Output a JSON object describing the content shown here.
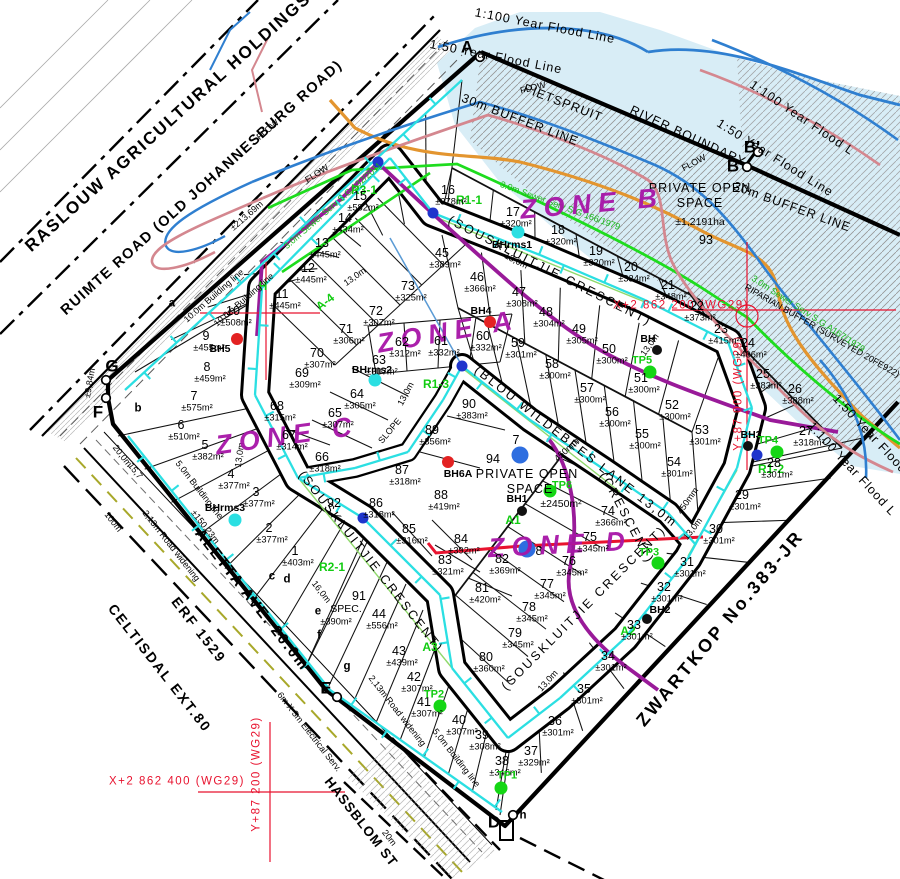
{
  "site": {
    "holdings": "RASLOUW AGRICULTURAL HOLDINGS",
    "ruimte": "RUIMTE ROAD (OLD JOHANNESBURG ROAD)",
    "zwartkop": "ZWARTKOP No.383-JR",
    "aletta": "ALETTA AVE. 20.0m",
    "erf1529": "ERF 1529",
    "celtisdal": "CELTISDAL EXT.80",
    "hassblom": "HASSBLOM ST"
  },
  "colors": {
    "flood_fill": "#d8edf6",
    "river": "#2f7fd0",
    "flood_50": "#d4878f",
    "buffer_30m": "#e3952f",
    "sewer": "#1edc1e",
    "water": "#2bdfe2",
    "zone_boundary": "#991a99",
    "grid_red": "#e8132f",
    "zone_text": "#a715a7"
  },
  "zones": [
    {
      "t": "ZONE A",
      "x": 448,
      "y": 332,
      "r": -10,
      "c": "zn"
    },
    {
      "t": "ZONE B",
      "x": 592,
      "y": 204,
      "r": -5,
      "c": "zn"
    },
    {
      "t": "ZONE C",
      "x": 287,
      "y": 436,
      "r": -8,
      "c": "zn"
    },
    {
      "t": "ZONE D",
      "x": 560,
      "y": 545,
      "r": -3,
      "c": "zn"
    }
  ],
  "labels": [
    {
      "t": "1:100 Year Flood Line",
      "x": 545,
      "y": 26,
      "r": 11,
      "c": "fl"
    },
    {
      "t": "1:50 Year Flood Line",
      "x": 496,
      "y": 57,
      "r": 11,
      "c": "fl"
    },
    {
      "t": "1:100 Year Flood L",
      "x": 802,
      "y": 118,
      "r": 34,
      "c": "fl"
    },
    {
      "t": "1:50 Year Flood Line",
      "x": 775,
      "y": 158,
      "r": 32,
      "c": "fl"
    },
    {
      "t": "1:50 Year Flood",
      "x": 870,
      "y": 434,
      "r": 47,
      "c": "fl"
    },
    {
      "t": "1:100 Year Flood L",
      "x": 852,
      "y": 469,
      "r": 47,
      "c": "fl"
    },
    {
      "t": "PIETSPRUIT",
      "x": 563,
      "y": 103,
      "r": 21,
      "c": "fl"
    },
    {
      "t": "RIVER BOUNDARY",
      "x": 688,
      "y": 136,
      "r": 25,
      "c": "fl"
    },
    {
      "t": "30m BUFFER LINE",
      "x": 520,
      "y": 120,
      "r": 21,
      "c": "fl"
    },
    {
      "t": "30m BUFFER LINE",
      "x": 792,
      "y": 207,
      "r": 20,
      "c": "fl"
    },
    {
      "t": "FLOW",
      "x": 268,
      "y": 130,
      "r": -40,
      "c": "dm"
    },
    {
      "t": "FLOW",
      "x": 317,
      "y": 174,
      "r": -33,
      "c": "dm"
    },
    {
      "t": "FLOW",
      "x": 533,
      "y": 88,
      "r": -14,
      "c": "dm"
    },
    {
      "t": "FLOW",
      "x": 694,
      "y": 163,
      "r": -28,
      "c": "dm"
    },
    {
      "t": "RIPARIAN BUFFER (SURVEYED 20FE922)",
      "x": 822,
      "y": 331,
      "r": 30,
      "c": "dm"
    },
    {
      "t": "(SOUSKLUITJIE CRESCENT)",
      "x": 550,
      "y": 271,
      "r": 27,
      "c": "rd"
    },
    {
      "t": "(SOUSKLUITJIE CRESCENT)",
      "x": 371,
      "y": 562,
      "r": 52,
      "c": "rd"
    },
    {
      "t": "(SOUSKLUITJIE CRESCENT)",
      "x": 584,
      "y": 608,
      "r": -45,
      "c": "rd"
    },
    {
      "t": "(CRESCENT)",
      "x": 627,
      "y": 518,
      "r": 62,
      "c": "rd"
    },
    {
      "t": "(BLOU WILDEBEES LANE 13,0m",
      "x": 576,
      "y": 447,
      "r": 38,
      "c": "rd"
    },
    {
      "t": "PRIVATE OPEN",
      "x": 700,
      "y": 188,
      "r": 0,
      "c": "os"
    },
    {
      "t": "SPACE",
      "x": 700,
      "y": 203,
      "r": 0,
      "c": "os"
    },
    {
      "t": "±1,2191ha",
      "x": 700,
      "y": 222,
      "r": 0,
      "c": "osa"
    },
    {
      "t": "93",
      "x": 706,
      "y": 240,
      "r": 0,
      "c": "num"
    },
    {
      "t": "94",
      "x": 493,
      "y": 459,
      "r": 0,
      "c": "num"
    },
    {
      "t": "PRIVATE OPEN",
      "x": 527,
      "y": 474,
      "r": 0,
      "c": "os"
    },
    {
      "t": "SPACE",
      "x": 530,
      "y": 489,
      "r": 0,
      "c": "os"
    },
    {
      "t": "±2450m²",
      "x": 561,
      "y": 504,
      "r": 0,
      "c": "osa"
    },
    {
      "t": "91",
      "x": 359,
      "y": 596,
      "r": 0,
      "c": "num"
    },
    {
      "t": "SPEC.",
      "x": 346,
      "y": 609,
      "r": 0,
      "c": "osa"
    },
    {
      "t": "±390m²",
      "x": 336,
      "y": 622,
      "r": 0,
      "c": "ar"
    },
    {
      "t": "92",
      "x": 334,
      "y": 503,
      "r": 0,
      "c": "num"
    },
    {
      "t": "7",
      "x": 516,
      "y": 440,
      "r": 0,
      "c": "num"
    },
    {
      "t": "8",
      "x": 539,
      "y": 551,
      "r": 0,
      "c": "num"
    },
    {
      "t": "3.0m Sewer Serv S.G.132/2011",
      "x": 333,
      "y": 206,
      "r": -41,
      "c": "gr"
    },
    {
      "t": "3.0m Sewer Serv S.G 166/1979",
      "x": 560,
      "y": 206,
      "r": 20,
      "c": "gr"
    },
    {
      "t": "3.0m Sewer Serv S.G.A167/1979",
      "x": 808,
      "y": 314,
      "r": 33,
      "c": "gr"
    },
    {
      "t": "R3-1",
      "x": 364,
      "y": 190,
      "r": 0,
      "c": "grb"
    },
    {
      "t": "R1-1",
      "x": 469,
      "y": 200,
      "r": 0,
      "c": "grb"
    },
    {
      "t": "A-4",
      "x": 325,
      "y": 302,
      "r": -38,
      "c": "grb"
    },
    {
      "t": "H",
      "x": 263,
      "y": 286,
      "r": 0,
      "c": "grb"
    },
    {
      "t": "R1-3",
      "x": 436,
      "y": 384,
      "r": 0,
      "c": "grb"
    },
    {
      "t": "A1",
      "x": 513,
      "y": 520,
      "r": 0,
      "c": "grb"
    },
    {
      "t": "A3",
      "x": 430,
      "y": 647,
      "r": 0,
      "c": "grb"
    },
    {
      "t": "A2",
      "x": 628,
      "y": 631,
      "r": 0,
      "c": "grb"
    },
    {
      "t": "R2-1",
      "x": 332,
      "y": 567,
      "r": 0,
      "c": "grb"
    },
    {
      "t": "R1-2",
      "x": 771,
      "y": 469,
      "r": 0,
      "c": "grb"
    },
    {
      "t": "X+2 862 200 (WG29)",
      "x": 681,
      "y": 306,
      "r": 0,
      "c": "rr"
    },
    {
      "t": "Y+87 000 (WG29)",
      "x": 739,
      "y": 393,
      "r": -90,
      "c": "rr"
    },
    {
      "t": "X+2 862 400 (WG29)",
      "x": 177,
      "y": 782,
      "r": 0,
      "c": "rr"
    },
    {
      "t": "Y+87 200 (WG29)",
      "x": 257,
      "y": 774,
      "r": -90,
      "c": "rr"
    },
    {
      "t": "±213,69m",
      "x": 247,
      "y": 216,
      "r": -41,
      "c": "dm"
    },
    {
      "t": "±150,23m",
      "x": 205,
      "y": 527,
      "r": 52,
      "c": "dm"
    },
    {
      "t": "100m",
      "x": 113,
      "y": 522,
      "r": 52,
      "c": "dm"
    },
    {
      "t": "20,0m",
      "x": 122,
      "y": 456,
      "r": 52,
      "c": "dm"
    },
    {
      "t": "15,7",
      "x": 135,
      "y": 471,
      "r": 52,
      "c": "dm"
    },
    {
      "t": "16,0m",
      "x": 321,
      "y": 592,
      "r": 52,
      "c": "dm"
    },
    {
      "t": "20m",
      "x": 389,
      "y": 838,
      "r": 52,
      "c": "dm"
    },
    {
      "t": "±9,84m",
      "x": 90,
      "y": 383,
      "r": -80,
      "c": "dm"
    },
    {
      "t": "13,0m",
      "x": 516,
      "y": 261,
      "r": 27,
      "c": "dm"
    },
    {
      "t": "13,0m",
      "x": 355,
      "y": 277,
      "r": -35,
      "c": "dm"
    },
    {
      "t": "13,0m",
      "x": 406,
      "y": 394,
      "r": -62,
      "c": "dm"
    },
    {
      "t": "13,0m",
      "x": 240,
      "y": 455,
      "r": -82,
      "c": "dm"
    },
    {
      "t": "13,0m",
      "x": 650,
      "y": 345,
      "r": -55,
      "c": "dm"
    },
    {
      "t": "13,0m",
      "x": 693,
      "y": 529,
      "r": -52,
      "c": "dm"
    },
    {
      "t": "13,0m",
      "x": 548,
      "y": 681,
      "r": -48,
      "c": "dm"
    },
    {
      "t": "10.0m Building line",
      "x": 214,
      "y": 296,
      "r": -41,
      "c": "dm"
    },
    {
      "t": "10.0m Building line",
      "x": 244,
      "y": 300,
      "r": -41,
      "c": "dm"
    },
    {
      "t": "5.0m Building line",
      "x": 199,
      "y": 490,
      "r": 52,
      "c": "dm"
    },
    {
      "t": "5,0m Building line",
      "x": 456,
      "y": 758,
      "r": 52,
      "c": "dm"
    },
    {
      "t": "2,13m Road widening",
      "x": 171,
      "y": 546,
      "r": 52,
      "c": "dm"
    },
    {
      "t": "2,13m Road widening",
      "x": 397,
      "y": 711,
      "r": 52,
      "c": "dm"
    },
    {
      "t": "6m X 3m Electrical Serv.",
      "x": 309,
      "y": 732,
      "r": 52,
      "c": "dm"
    },
    {
      "t": "SLOPE",
      "x": 390,
      "y": 431,
      "r": -50,
      "c": "dm"
    },
    {
      "t": "450mm",
      "x": 567,
      "y": 450,
      "r": -42,
      "c": "dm"
    },
    {
      "t": "450mm",
      "x": 688,
      "y": 501,
      "r": -55,
      "c": "dm"
    },
    {
      "t": "A",
      "x": 467,
      "y": 47,
      "r": 0,
      "c": "lt"
    },
    {
      "t": "B",
      "x": 733,
      "y": 166,
      "r": 0,
      "c": "lt"
    },
    {
      "t": "B'",
      "x": 752,
      "y": 147,
      "r": 0,
      "c": "lt"
    },
    {
      "t": "D",
      "x": 494,
      "y": 822,
      "r": 0,
      "c": "lt"
    },
    {
      "t": "E",
      "x": 326,
      "y": 688,
      "r": 0,
      "c": "lt"
    },
    {
      "t": "F",
      "x": 98,
      "y": 412,
      "r": 0,
      "c": "lt"
    },
    {
      "t": "G",
      "x": 112,
      "y": 366,
      "r": 0,
      "c": "lt"
    },
    {
      "t": "a",
      "x": 172,
      "y": 304,
      "r": 0,
      "c": "ls"
    },
    {
      "t": "b",
      "x": 138,
      "y": 409,
      "r": 0,
      "c": "ls"
    },
    {
      "t": "c",
      "x": 272,
      "y": 577,
      "r": 0,
      "c": "ls"
    },
    {
      "t": "d",
      "x": 287,
      "y": 580,
      "r": 0,
      "c": "ls"
    },
    {
      "t": "e",
      "x": 318,
      "y": 612,
      "r": 0,
      "c": "ls"
    },
    {
      "t": "f",
      "x": 319,
      "y": 636,
      "r": 0,
      "c": "ls"
    },
    {
      "t": "g",
      "x": 347,
      "y": 667,
      "r": 0,
      "c": "ls"
    },
    {
      "t": "h",
      "x": 523,
      "y": 816,
      "r": 0,
      "c": "ls"
    }
  ],
  "plots": [
    [
      1,
      "±403m²",
      295,
      551
    ],
    [
      2,
      "±377m²",
      269,
      528
    ],
    [
      3,
      "±377m²",
      256,
      492
    ],
    [
      4,
      "±377m²",
      231,
      474
    ],
    [
      5,
      "±382m²",
      205,
      445
    ],
    [
      6,
      "±510m²",
      181,
      425
    ],
    [
      7,
      "±575m²",
      194,
      396
    ],
    [
      8,
      "±459m²",
      207,
      367
    ],
    [
      9,
      "±455m²",
      206,
      336
    ],
    [
      10,
      "±508m²",
      233,
      311
    ],
    [
      11,
      "±445m²",
      282,
      294
    ],
    [
      12,
      "±445m²",
      308,
      268
    ],
    [
      13,
      "±445m²",
      322,
      243
    ],
    [
      14,
      "±434m²",
      345,
      218
    ],
    [
      15,
      "±582m²",
      360,
      196
    ],
    [
      16,
      "±378m²",
      448,
      190
    ],
    [
      17,
      "±320m²",
      513,
      212
    ],
    [
      18,
      "±320m²",
      558,
      230
    ],
    [
      19,
      "±320m²",
      596,
      251
    ],
    [
      20,
      "±334m²",
      631,
      267
    ],
    [
      21,
      "±348m²",
      668,
      285
    ],
    [
      22,
      "±373m²",
      697,
      306
    ],
    [
      23,
      "±415m²",
      721,
      329
    ],
    [
      24,
      "±406m²",
      748,
      343
    ],
    [
      25,
      "±383m²",
      763,
      374
    ],
    [
      26,
      "±388m²",
      795,
      389
    ],
    [
      27,
      "±318m²",
      806,
      431
    ],
    [
      28,
      "±301m²",
      774,
      463
    ],
    [
      29,
      "±301m²",
      742,
      495
    ],
    [
      30,
      "±301m²",
      716,
      529
    ],
    [
      31,
      "±301m²",
      687,
      562
    ],
    [
      32,
      "±301m²",
      664,
      587
    ],
    [
      33,
      "±301m²",
      634,
      625
    ],
    [
      34,
      "±301m²",
      608,
      656
    ],
    [
      35,
      "±301m²",
      584,
      689
    ],
    [
      36,
      "±301m²",
      555,
      721
    ],
    [
      37,
      "±329m²",
      531,
      751
    ],
    [
      38,
      "±346m²",
      502,
      761
    ],
    [
      39,
      "±308m²",
      482,
      735
    ],
    [
      40,
      "±307m²",
      459,
      720
    ],
    [
      41,
      "±307m²",
      424,
      702
    ],
    [
      42,
      "±307m²",
      414,
      677
    ],
    [
      43,
      "±439m²",
      399,
      651
    ],
    [
      44,
      "±556m²",
      379,
      614
    ],
    [
      45,
      "±389m²",
      442,
      253
    ],
    [
      46,
      "±366m²",
      477,
      277
    ],
    [
      47,
      "±308m²",
      519,
      292
    ],
    [
      48,
      "±304m²",
      546,
      312
    ],
    [
      49,
      "±305m²",
      579,
      329
    ],
    [
      50,
      "±300m²",
      609,
      349
    ],
    [
      51,
      "±300m²",
      641,
      378
    ],
    [
      52,
      "±300m²",
      672,
      405
    ],
    [
      53,
      "±301m²",
      702,
      430
    ],
    [
      54,
      "±301m²",
      674,
      462
    ],
    [
      55,
      "±300m²",
      642,
      434
    ],
    [
      56,
      "±300m²",
      612,
      412
    ],
    [
      57,
      "±300m²",
      587,
      388
    ],
    [
      58,
      "±300m²",
      552,
      364
    ],
    [
      59,
      "±301m²",
      518,
      343
    ],
    [
      60,
      "±332m²",
      483,
      336
    ],
    [
      61,
      "±332m²",
      441,
      341
    ],
    [
      62,
      "±312m²",
      402,
      342
    ],
    [
      63,
      "±307m²",
      379,
      360
    ],
    [
      64,
      "±305m²",
      357,
      394
    ],
    [
      65,
      "±307m²",
      335,
      413
    ],
    [
      66,
      "±318m²",
      322,
      457
    ],
    [
      67,
      "±314m²",
      289,
      435
    ],
    [
      68,
      "±315m²",
      277,
      406
    ],
    [
      69,
      "±309m²",
      302,
      373
    ],
    [
      70,
      "±307m²",
      317,
      353
    ],
    [
      71,
      "±306m²",
      346,
      329
    ],
    [
      72,
      "±307m²",
      376,
      311
    ],
    [
      73,
      "±325m²",
      408,
      286
    ],
    [
      74,
      "±366m²",
      608,
      511
    ],
    [
      75,
      "±345m²",
      590,
      537
    ],
    [
      76,
      "±345m²",
      569,
      561
    ],
    [
      77,
      "±345m²",
      547,
      584
    ],
    [
      78,
      "±345m²",
      529,
      607
    ],
    [
      79,
      "±345m²",
      515,
      633
    ],
    [
      80,
      "±360m²",
      486,
      657
    ],
    [
      81,
      "±420m²",
      482,
      588
    ],
    [
      82,
      "±369m²",
      502,
      559
    ],
    [
      83,
      "±321m²",
      445,
      560
    ],
    [
      84,
      "±392m²",
      461,
      539
    ],
    [
      85,
      "±316m²",
      409,
      529
    ],
    [
      86,
      "±318m²",
      376,
      503
    ],
    [
      87,
      "±318m²",
      402,
      470
    ],
    [
      88,
      "±419m²",
      441,
      495
    ],
    [
      89,
      "±356m²",
      432,
      430
    ],
    [
      90,
      "±383m²",
      469,
      404
    ]
  ],
  "markers": {
    "boreholes": [
      {
        "id": "BH5",
        "type": "red",
        "x": 237,
        "y": 339,
        "lx": 220,
        "ly": 349
      },
      {
        "id": "BH4",
        "type": "red",
        "x": 490,
        "y": 322,
        "lx": 481,
        "ly": 311
      },
      {
        "id": "BH6A",
        "type": "red",
        "x": 448,
        "y": 462,
        "lx": 458,
        "ly": 474
      },
      {
        "id": "BH1",
        "type": "black",
        "x": 522,
        "y": 511,
        "lx": 517,
        "ly": 499
      },
      {
        "id": "BH2",
        "type": "black",
        "x": 647,
        "y": 619,
        "lx": 660,
        "ly": 610
      },
      {
        "id": "BH3",
        "type": "black",
        "x": 748,
        "y": 446,
        "lx": 751,
        "ly": 435
      },
      {
        "id": "BH",
        "type": "black",
        "x": 657,
        "y": 350,
        "lx": 648,
        "ly": 339
      },
      {
        "id": "BHrms1",
        "type": "cyan",
        "x": 518,
        "y": 232,
        "lx": 512,
        "ly": 245
      },
      {
        "id": "BHrms2",
        "type": "cyan",
        "x": 375,
        "y": 380,
        "lx": 372,
        "ly": 370
      },
      {
        "id": "BHrms3",
        "type": "cyan",
        "x": 235,
        "y": 520,
        "lx": 225,
        "ly": 508
      }
    ],
    "trial_pits": [
      {
        "id": "TP1",
        "x": 501,
        "y": 788,
        "lx": 507,
        "ly": 776
      },
      {
        "id": "TP2",
        "x": 440,
        "y": 706,
        "lx": 434,
        "ly": 695
      },
      {
        "id": "TP3",
        "x": 658,
        "y": 563,
        "lx": 649,
        "ly": 553
      },
      {
        "id": "TP4",
        "x": 777,
        "y": 452,
        "lx": 768,
        "ly": 441
      },
      {
        "id": "TP5",
        "x": 650,
        "y": 372,
        "lx": 642,
        "ly": 361
      },
      {
        "id": "TP6",
        "x": 550,
        "y": 491,
        "lx": 562,
        "ly": 486
      }
    ],
    "monitor_wells": [
      [
        520,
        455
      ],
      [
        527,
        549
      ]
    ],
    "junction_nodes": [
      [
        378,
        162
      ],
      [
        433,
        213
      ],
      [
        462,
        366
      ],
      [
        363,
        518
      ],
      [
        757,
        455
      ]
    ],
    "beacons": [
      [
        480,
        57
      ],
      [
        747,
        167
      ],
      [
        758,
        152
      ],
      [
        337,
        697
      ],
      [
        106,
        398
      ],
      [
        106,
        380
      ],
      [
        513,
        815
      ]
    ]
  }
}
